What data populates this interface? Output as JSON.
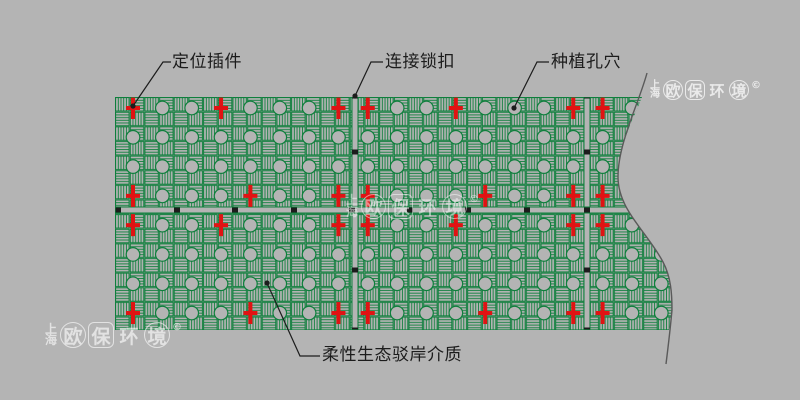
{
  "colors": {
    "background": "#b4b4b4",
    "panel_green": "#0e7f3c",
    "plug_red": "#e01313",
    "ink": "#1c1c1c",
    "break_line_gray": "#5a5a5a",
    "watermark_white": "#ffffff"
  },
  "watermark": {
    "city_top": "上",
    "city_bottom": "海",
    "brand_chars": [
      "欧",
      "保",
      "环",
      "境"
    ],
    "mark": "©"
  },
  "callouts": [
    {
      "id": "positioning-plug",
      "label": "定位插件",
      "points": [
        [
          133,
          106
        ],
        [
          163,
          62
        ],
        [
          171,
          62
        ]
      ],
      "text": [
        172,
        53
      ]
    },
    {
      "id": "connection-lock",
      "label": "连接锁扣",
      "points": [
        [
          355,
          96
        ],
        [
          371,
          62
        ],
        [
          383,
          62
        ]
      ],
      "text": [
        385,
        53
      ]
    },
    {
      "id": "planting-hole",
      "label": "种植孔穴",
      "points": [
        [
          514,
          108
        ],
        [
          537,
          62
        ],
        [
          549,
          62
        ]
      ],
      "text": [
        551,
        53
      ]
    },
    {
      "id": "revetment-medium",
      "label": "柔性生态驳岸介质",
      "points": [
        [
          267,
          283
        ],
        [
          300,
          356
        ],
        [
          320,
          356
        ]
      ],
      "text": [
        322,
        346
      ]
    }
  ],
  "diagram": {
    "panel": {
      "left": 115,
      "top": 97,
      "right": 675,
      "bottom": 330
    },
    "grid": {
      "x0": 133,
      "y0": 108,
      "dx": 29.35,
      "dy": 29.29,
      "cols": 19,
      "rows": 8
    },
    "hole_radius": 6.8,
    "cross_rows": {
      "0": [
        0,
        3,
        7,
        8,
        11,
        15,
        16
      ],
      "3": [
        0,
        4,
        7,
        8,
        12,
        15,
        16
      ],
      "4": [
        0,
        3,
        7,
        8,
        11,
        15,
        16
      ],
      "7": [
        0,
        4,
        7,
        8,
        12,
        15,
        16
      ]
    },
    "joints": {
      "vertical_x": [
        355,
        587
      ],
      "horizontal_y": 210
    },
    "locks": {
      "horizontal_x": [
        118,
        177,
        235,
        294,
        352,
        410,
        468,
        527,
        587
      ],
      "vertical_y": [
        96,
        152,
        270,
        330
      ]
    },
    "break_curve": "M647,73 C639,103 618,143 618,177 C618,210 648,233 663,262 C671,277 672,294 672,310 C670,332 668,348 666,364",
    "clip_path": "M115,97 L642,97 C635,115 618,146 618,177 C618,210 648,233 663,262 C671,277 672,294 672,310 C671,318 670,324 669,330 L115,330 Z"
  }
}
